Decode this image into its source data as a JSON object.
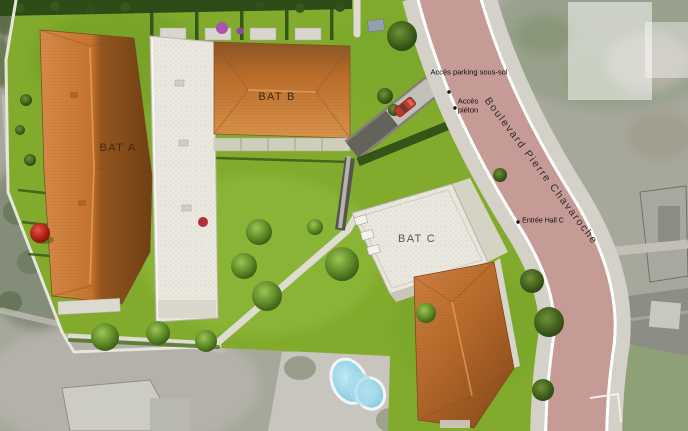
{
  "scene": {
    "type": "residential-site-plan",
    "buildings": [
      {
        "id": "bat-a",
        "label": "BAT A"
      },
      {
        "id": "bat-b",
        "label": "BAT B"
      },
      {
        "id": "bat-c",
        "label": "BAT C"
      }
    ],
    "street": {
      "name": "Boulevard Pierre Chavaroche"
    },
    "annotations": [
      {
        "id": "access-parking",
        "label": "Accès parking sous-sol"
      },
      {
        "id": "access-pieton",
        "label": "Accès piéton"
      },
      {
        "id": "entree-hall-c",
        "label": "Entrée Hall C"
      }
    ],
    "colors": {
      "lawn": "#82ab2d",
      "roof_tile": "#c87a36",
      "roof_gravel": "#eae7de",
      "road_asphalt": "#c79b95",
      "sidewalk": "#d3d1c8",
      "aerial_ground": "#a6a89b",
      "pool_water": "#96d2e8",
      "red_car": "#c0392b",
      "red_tree": "#b02418"
    }
  }
}
